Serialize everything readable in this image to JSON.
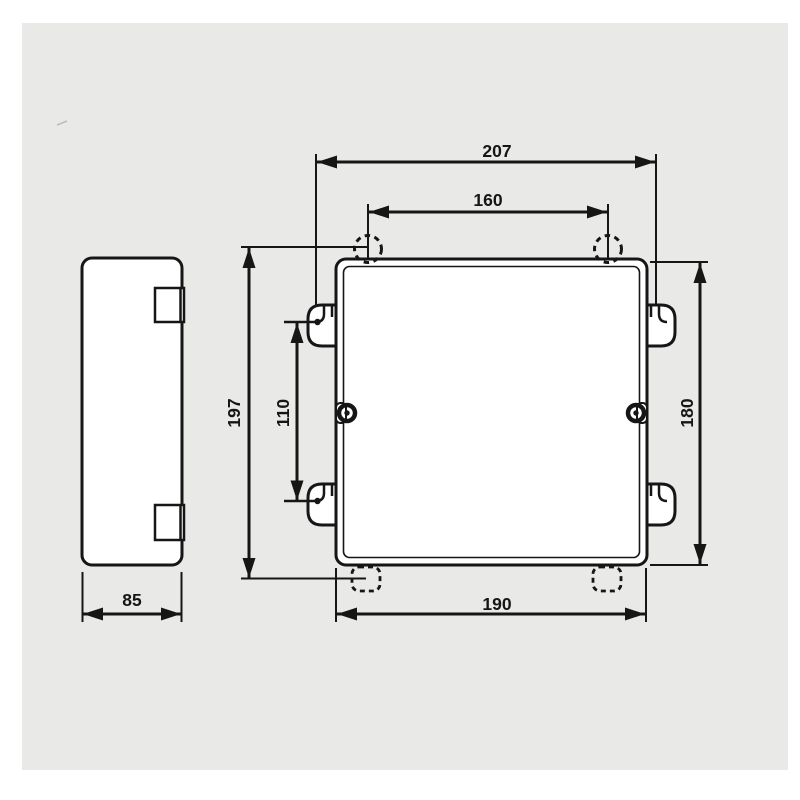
{
  "page": {
    "background_color": "#ffffff",
    "panel_color": "#e9e9e8",
    "line_color": "#161616"
  },
  "drawing": {
    "type": "technical-dimension-drawing",
    "dimensions": {
      "overall_width": "207",
      "hole_spacing": "160",
      "overall_height": "197",
      "tab_spacing": "110",
      "body_height": "180",
      "body_width": "190",
      "depth": "85"
    }
  }
}
